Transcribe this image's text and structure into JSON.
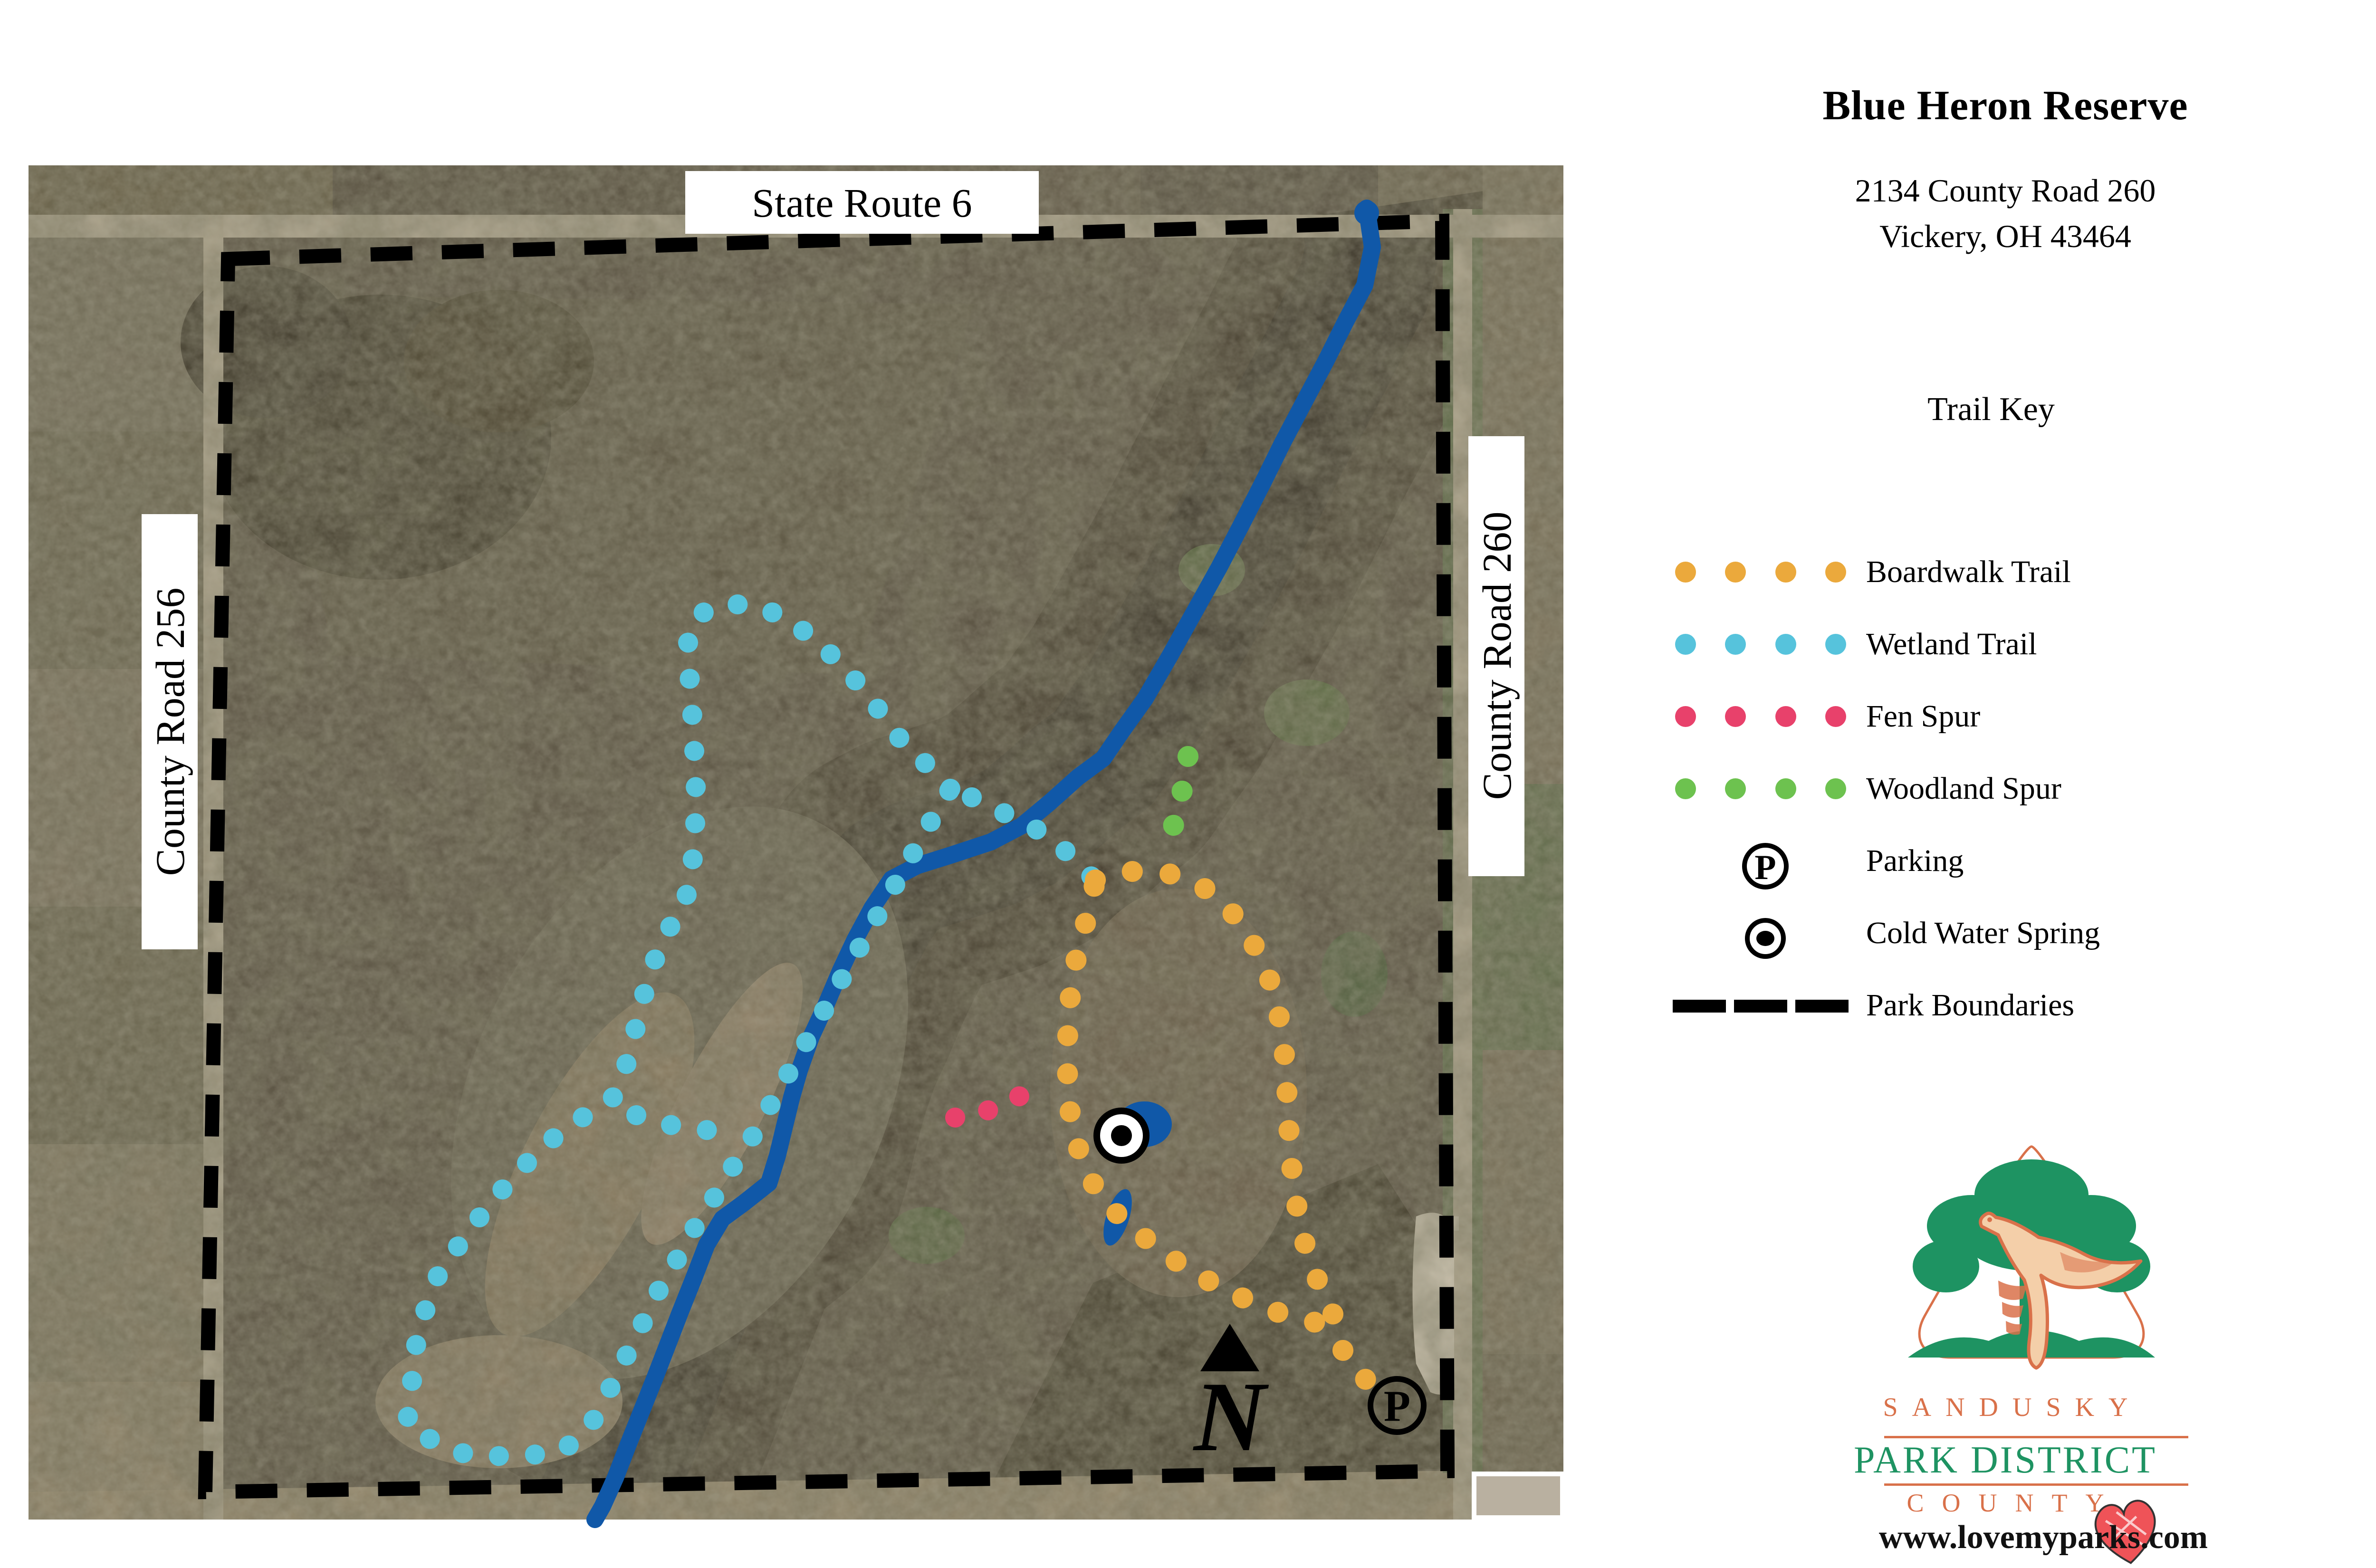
{
  "map": {
    "road_labels": {
      "top": "State Route 6",
      "left": "County Road 256",
      "right": "County Road 260"
    },
    "icons": {
      "parking_letter": "P",
      "north_letter": "N"
    },
    "features": {
      "stream": "unnamed stream",
      "spring": "Cold Water Spring",
      "parking": "Parking lot"
    }
  },
  "panel": {
    "title": "Blue Heron Reserve",
    "address_line1": "2134 County Road 260",
    "address_line2": "Vickery, OH  43464",
    "key_title": "Trail Key",
    "legend": {
      "items": [
        {
          "label": "Boardwalk Trail",
          "type": "dots",
          "color": "#EBA93C"
        },
        {
          "label": "Wetland Trail",
          "type": "dots",
          "color": "#56C3DC"
        },
        {
          "label": "Fen Spur",
          "type": "dots",
          "color": "#E8416B"
        },
        {
          "label": "Woodland Spur",
          "type": "dots",
          "color": "#6DC24F"
        },
        {
          "label": "Parking",
          "type": "parking-icon"
        },
        {
          "label": "Cold Water Spring",
          "type": "spring-icon"
        },
        {
          "label": "Park Boundaries",
          "type": "dashes",
          "color": "#000000"
        }
      ]
    }
  },
  "logo": {
    "line1": "SANDUSKY",
    "line2": "PARK DISTRICT",
    "line3": "COUNTY",
    "url": "www.lovemyparks.com"
  },
  "colors": {
    "boardwalk": "#EBA93C",
    "wetland": "#56C3DC",
    "fen": "#E8416B",
    "woodland": "#6DC24F",
    "stream": "#1058A8",
    "boundary": "#000000",
    "logo_orange": "#D9714A",
    "logo_green": "#1E9362"
  }
}
